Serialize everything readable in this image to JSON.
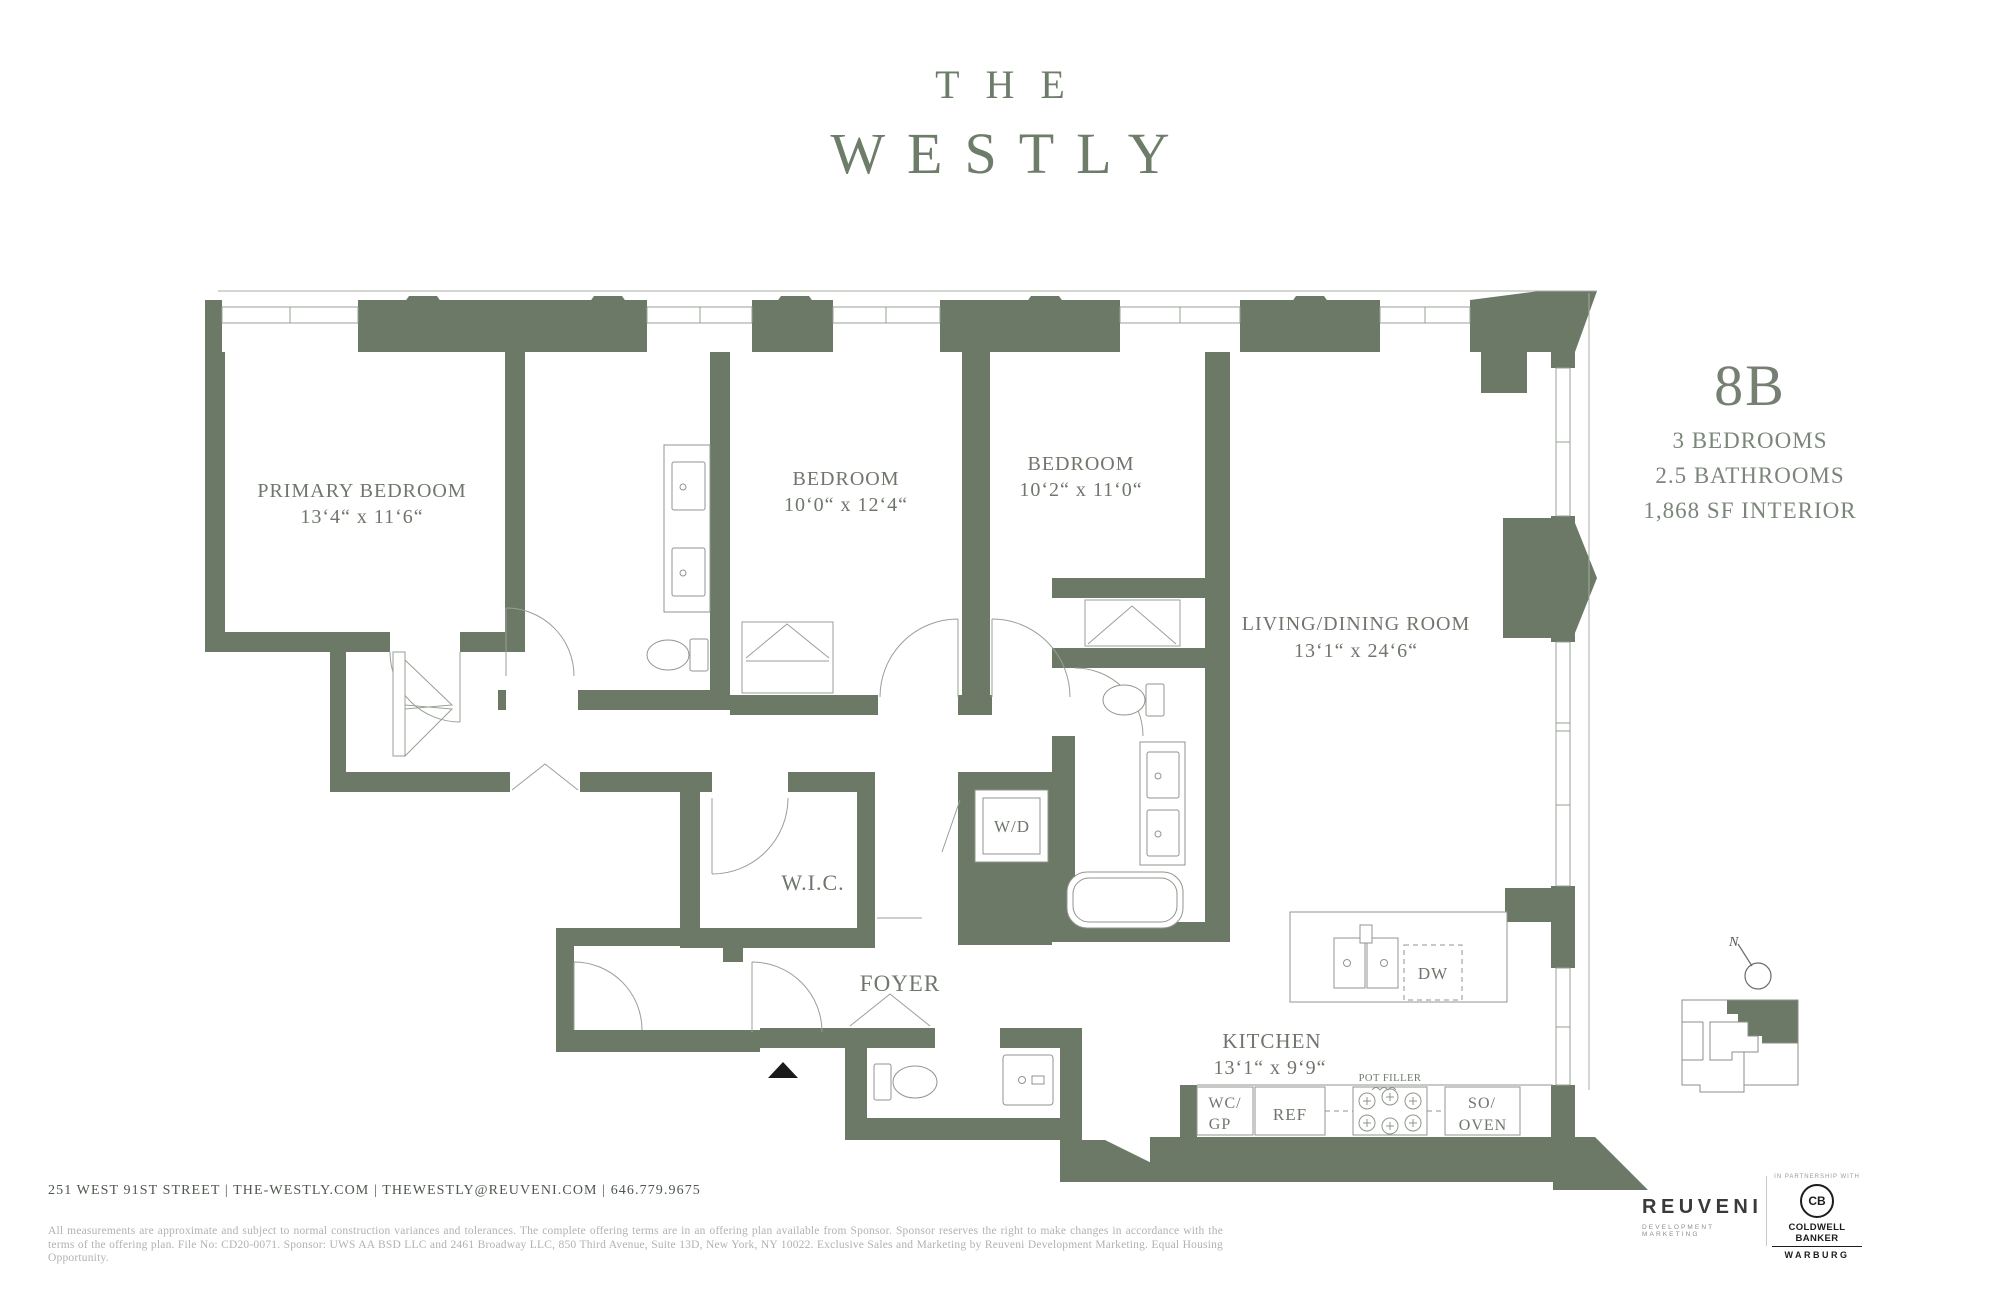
{
  "title": {
    "line1": "THE",
    "line2": "WESTLY"
  },
  "unit": {
    "number": "8B",
    "spec1": "3 BEDROOMS",
    "spec2": "2.5 BATHROOMS",
    "spec3": "1,868 SF INTERIOR"
  },
  "plan": {
    "primary_bedroom": {
      "name": "PRIMARY BEDROOM",
      "dims": "13‘4“ x 11‘6“"
    },
    "bedroom_a": {
      "name": "BEDROOM",
      "dims": "10‘0“ x 12‘4“"
    },
    "bedroom_b": {
      "name": "BEDROOM",
      "dims": "10‘2“ x 11‘0“"
    },
    "living": {
      "name": "LIVING/DINING ROOM",
      "dims": "13‘1“ x 24‘6“"
    },
    "kitchen": {
      "name": "KITCHEN",
      "dims": "13‘1“ x 9‘9“"
    },
    "wic": "W.I.C.",
    "foyer": "FOYER",
    "wd": "W/D",
    "dw": "DW",
    "pot_filler": "POT FILLER",
    "wc_gp_1": "WC/",
    "wc_gp_2": "GP",
    "ref": "REF",
    "so_oven_1": "SO/",
    "so_oven_2": "OVEN",
    "compass": "N"
  },
  "footer": {
    "contact": "251 WEST 91ST STREET  |  THE-WESTLY.COM  |  THEWESTLY@REUVENI.COM  |  646.779.9675",
    "disclaimer": "All measurements are approximate and subject to normal construction variances and tolerances. The complete offering terms are in an offering plan available from Sponsor. Sponsor reserves the right to make changes in accordance with the terms of the offering plan. File No: CD20-0071. Sponsor: UWS AA BSD LLC and 2461 Broadway LLC, 850 Third Avenue, Suite 13D, New York, NY 10022. Exclusive Sales and Marketing by Reuveni Development Marketing. Equal Housing Opportunity."
  },
  "branding": {
    "reuveni": "REUVENI",
    "reuveni_sub": "DEVELOPMENT MARKETING",
    "partnership": "IN PARTNERSHIP WITH",
    "cb_monogram": "CB",
    "cb_name": "COLDWELL BANKER",
    "cb_sub": "WARBURG"
  },
  "colors": {
    "wall": "#6c7966",
    "line": "#98a094",
    "label": "#6f766c",
    "brand": "#6e7c6a",
    "footer_text": "#4e564e",
    "disclaimer": "#b0b3af"
  }
}
